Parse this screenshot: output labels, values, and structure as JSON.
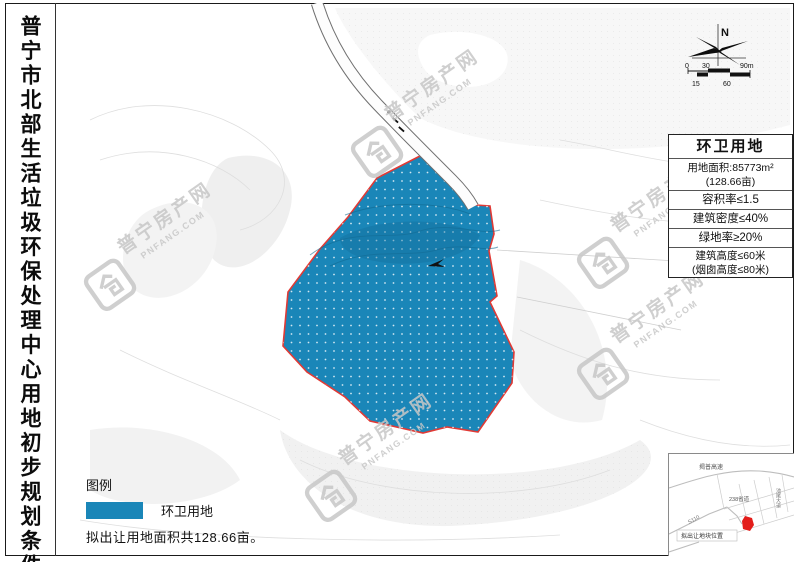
{
  "document": {
    "title": "普宁市北部生活垃圾环保处理中心用地初步规划条件"
  },
  "compass": {
    "north_label": "N"
  },
  "scale_bar": {
    "top_labels": [
      "0",
      "30",
      "90m"
    ],
    "bottom_labels": [
      "15",
      "60"
    ]
  },
  "info_box": {
    "title": "环卫用地",
    "area_line1": "用地面积:85773m²",
    "area_line2": "(128.66亩)",
    "far": "容积率≤1.5",
    "density": "建筑密度≤40%",
    "green": "绿地率≥20%",
    "height_line1": "建筑高度≤60米",
    "height_line2": "(烟囱高度≤80米)"
  },
  "legend": {
    "heading": "图例",
    "item_label": "环卫用地",
    "note": "拟出让用地面积共128.66亩。",
    "swatch_color": "#1a86b8"
  },
  "map": {
    "parcel_fill": "#1a86b8",
    "parcel_border": "#e03a35"
  },
  "inset": {
    "expressway_label": "揭普高速",
    "road_label": "238省道",
    "s_road_label": "S110",
    "avenue_label": "池尾大道",
    "location_label": "拟出让地块位置"
  },
  "watermark": {
    "brand": "普宁房产网",
    "domain": "PNFANG.COM"
  }
}
